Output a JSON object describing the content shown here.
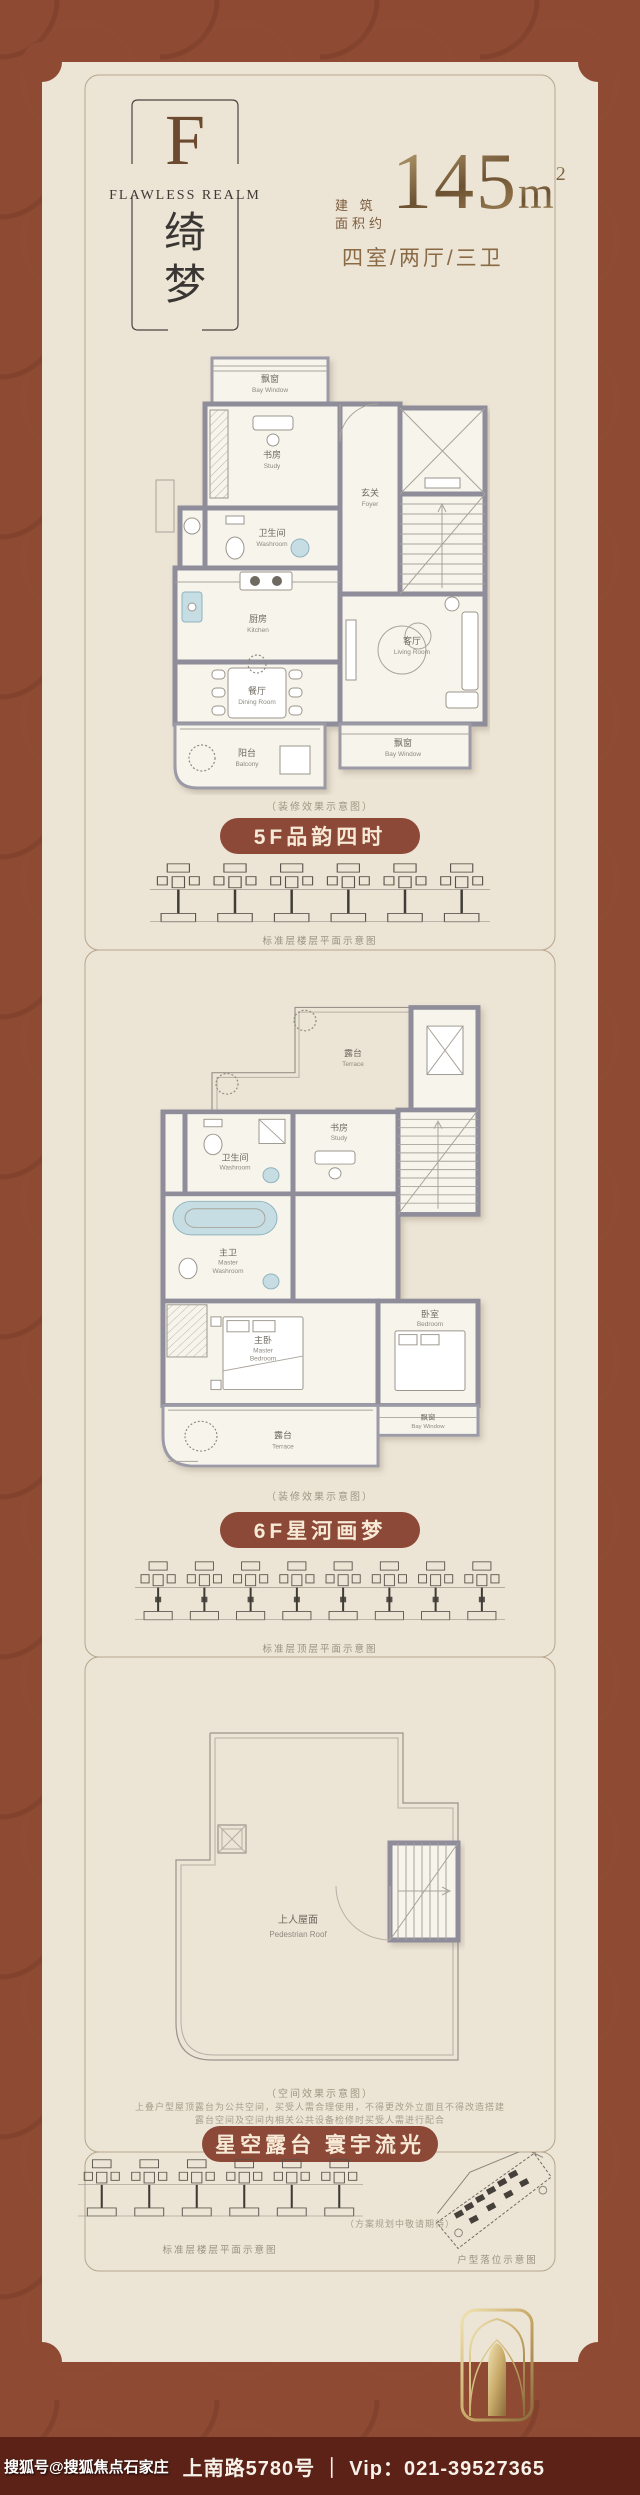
{
  "header": {
    "monogram": "F",
    "brand_en": "FLAWLESS REALM",
    "brand_cn_1": "绮",
    "brand_cn_2": "梦",
    "area_label_1": "建 筑",
    "area_label_2": "面积约",
    "area_value": "145",
    "area_unit": "m",
    "area_exponent": "2",
    "layout_text": "四室/两厅/三卫"
  },
  "floor5": {
    "badge": "5F品韵四时",
    "caption": "（装修效果示意图）",
    "keyplan_caption": "标准层楼层平面示意图",
    "rooms": {
      "bay_top_cn": "飘窗",
      "bay_top_en": "Bay Window",
      "study_cn": "书房",
      "study_en": "Study",
      "foyer_cn": "玄关",
      "foyer_en": "Foyer",
      "washroom_cn": "卫生间",
      "washroom_en": "Washroom",
      "kitchen_cn": "厨房",
      "kitchen_en": "Kitchen",
      "dining_cn": "餐厅",
      "dining_en": "Dining Room",
      "living_cn": "客厅",
      "living_en": "Living Room",
      "balcony_cn": "阳台",
      "balcony_en": "Balcony",
      "bay_bottom_cn": "飘窗",
      "bay_bottom_en": "Bay Window"
    }
  },
  "floor6": {
    "badge": "6F星河画梦",
    "caption": "（装修效果示意图）",
    "keyplan_caption": "标准层顶层平面示意图",
    "rooms": {
      "terrace_top_cn": "露台",
      "terrace_top_en": "Terrace",
      "washroom_cn": "卫生间",
      "washroom_en": "Washroom",
      "study_cn": "书房",
      "study_en": "Study",
      "master_wash_cn": "主卫",
      "master_wash_en1": "Master",
      "master_wash_en2": "Washroom",
      "master_bed_cn": "主卧",
      "master_bed_en1": "Master",
      "master_bed_en2": "Bedroom",
      "bedroom_cn": "卧室",
      "bedroom_en": "Bedroom",
      "bay_cn": "飘窗",
      "bay_en": "Bay Window",
      "terrace_bottom_cn": "露台",
      "terrace_bottom_en": "Terrace"
    }
  },
  "roof": {
    "badge": "星空露台 寰宇流光",
    "caption": "（空间效果示意图）",
    "note_1": "上叠户型屋顶露台为公共空间，买受人需合理使用，不得更改外立面且不得改造搭建",
    "note_2": "露台空间及空间内相关公共设备检修时买受人需进行配合",
    "label_cn": "上人屋面",
    "label_en": "Pedestrian Roof"
  },
  "bottom": {
    "keyplan_caption": "标准层楼层平面示意图",
    "siteplan_note": "（方案规划中敬请期待）",
    "siteplan_caption": "户型落位示意图"
  },
  "footer": {
    "watermark": "搜狐号@搜狐焦点石家庄",
    "main": "上南路5780号 ｜ Vip：021-39527365"
  },
  "colors": {
    "background_brown": "#8e4a33",
    "panel_cream": "#ece4d5",
    "badge_brown": "#8c4937",
    "gold_text": "#8f7148",
    "footer_bar": "#5c2217",
    "wall_gray": "#8e8d99",
    "bathtub_blue": "#c6dde4"
  }
}
